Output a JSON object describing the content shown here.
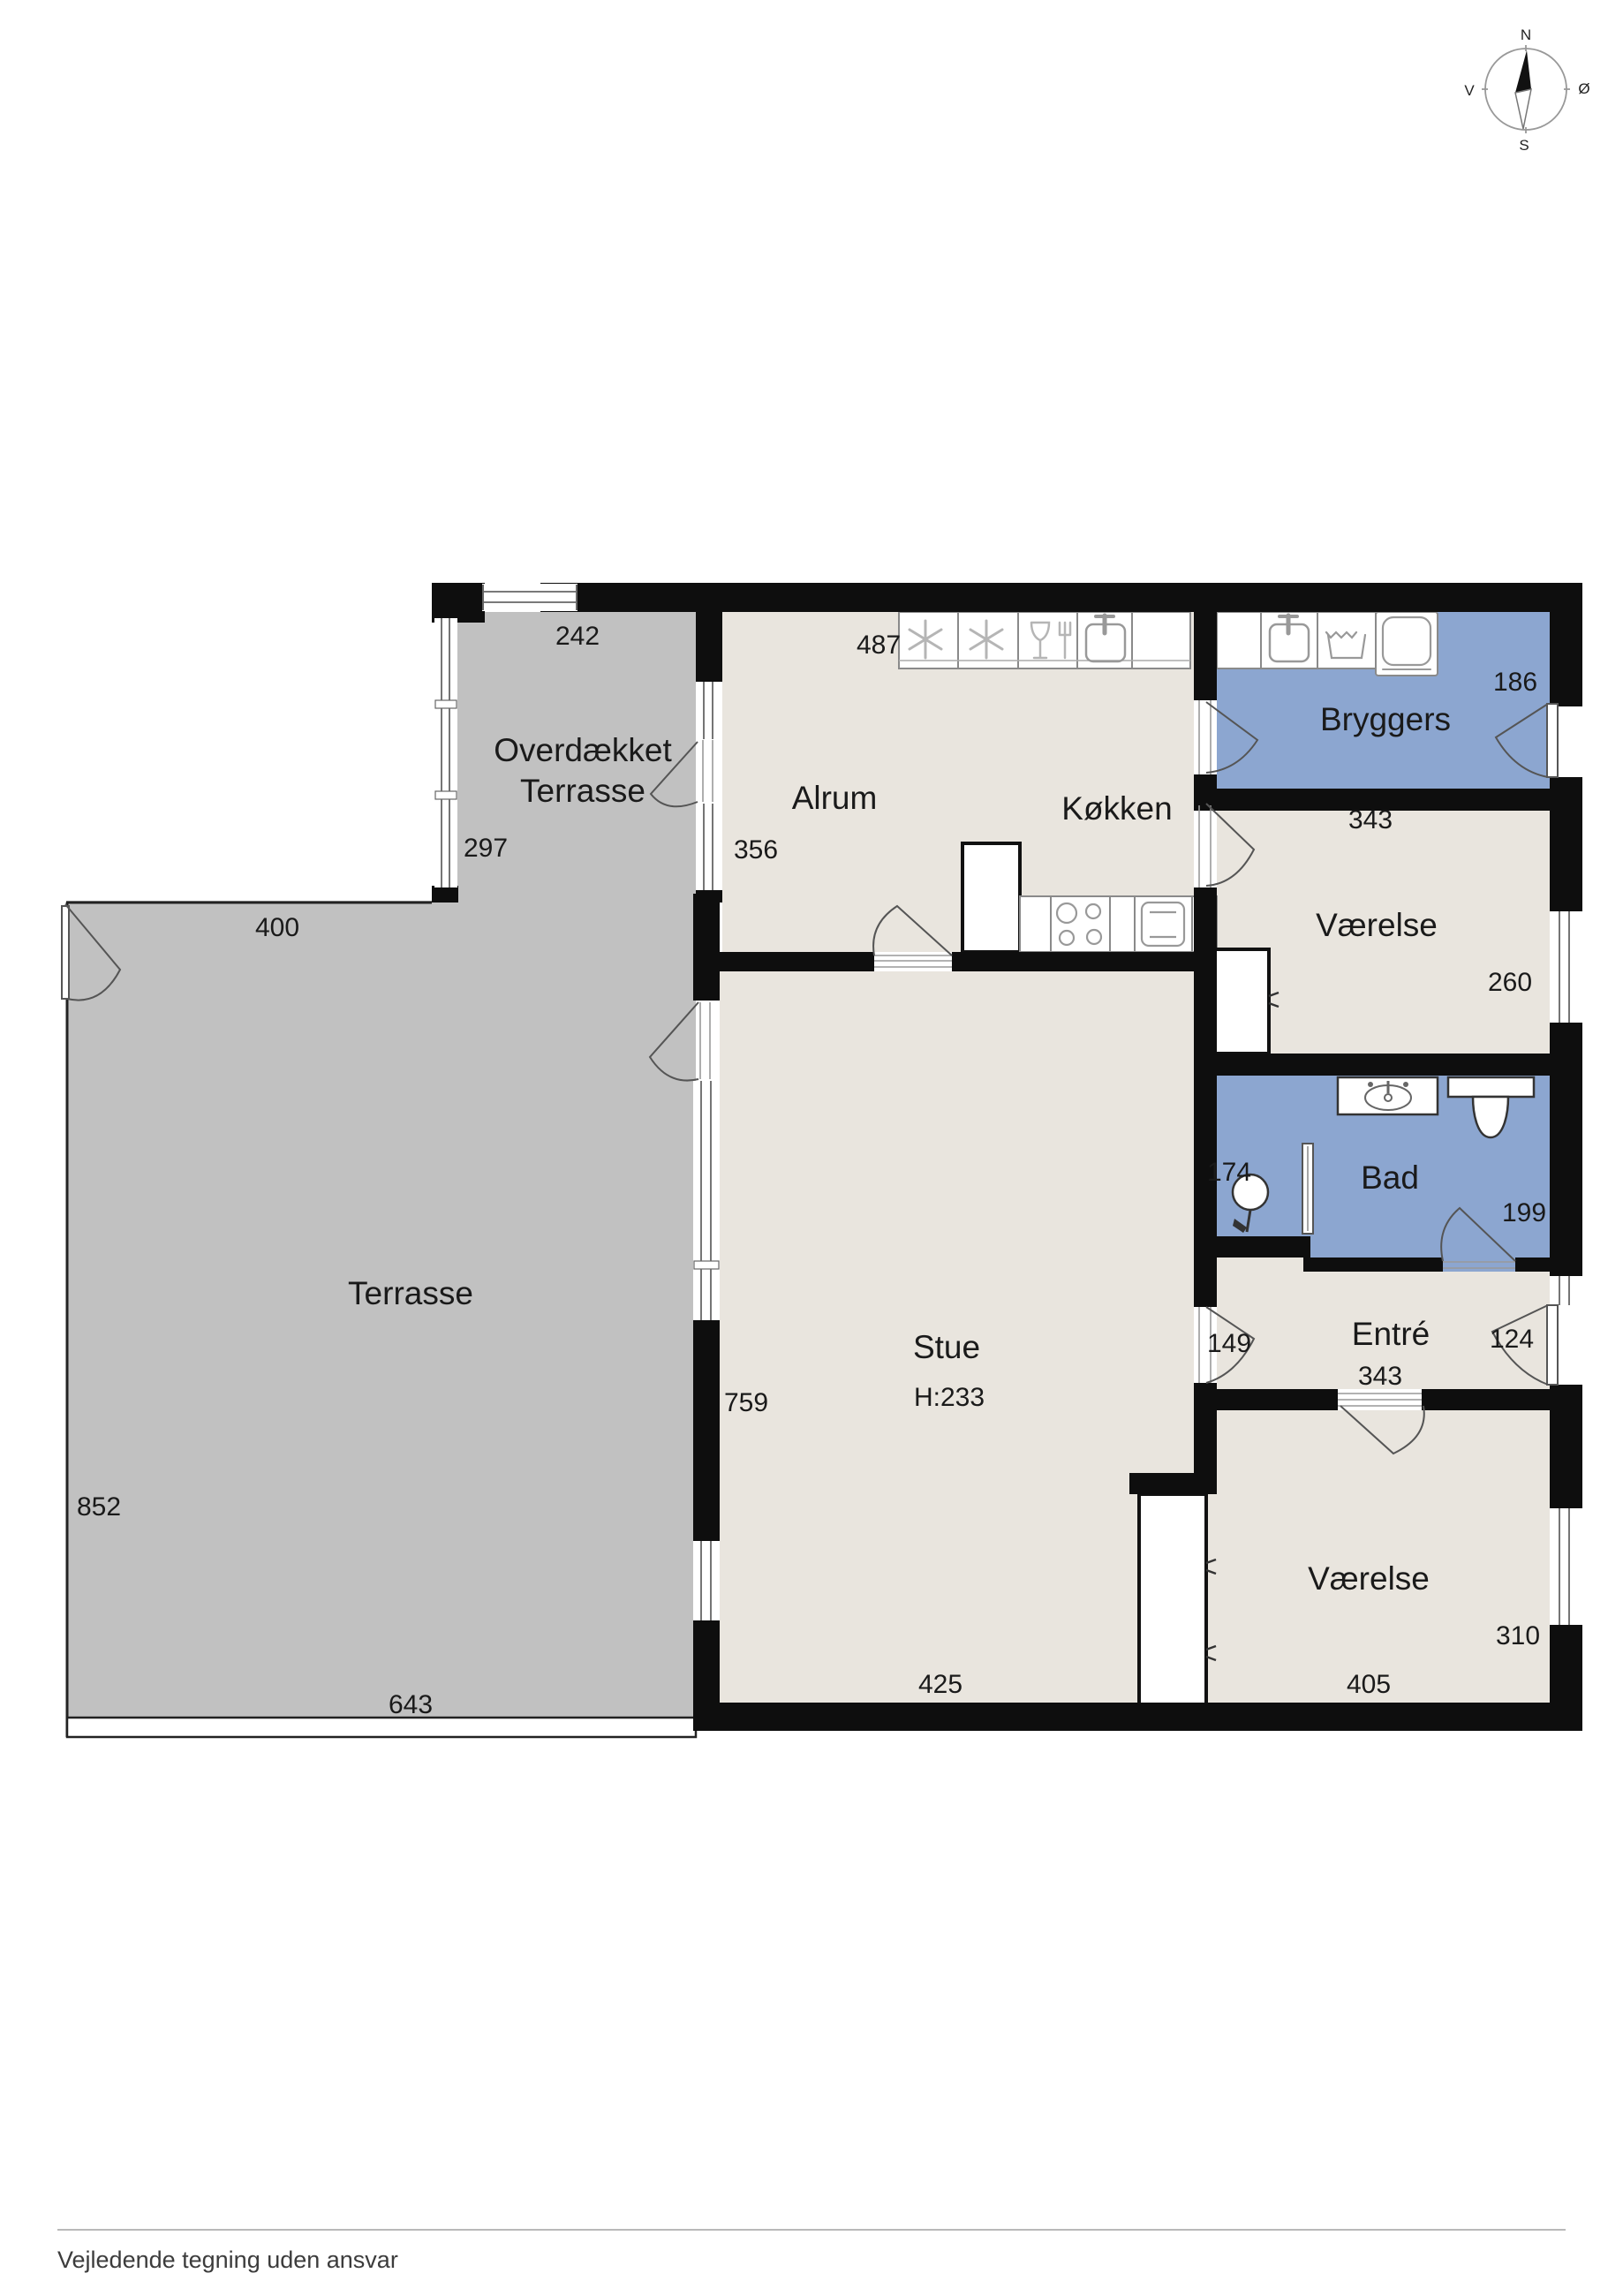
{
  "colors": {
    "terrace": "#c1c1c1",
    "floor": "#e9e5de",
    "wet": "#8ca6d0",
    "wall": "#0e0e0e",
    "white": "#ffffff"
  },
  "compass": {
    "north": "N",
    "south": "S",
    "west": "V",
    "east": "Ø"
  },
  "rooms": {
    "covered_terrace": {
      "label_line1": "Overdækket",
      "label_line2": "Terrasse",
      "dim_top": "242",
      "dim_left": "297"
    },
    "terrace": {
      "label": "Terrasse",
      "dim_top": "400",
      "dim_left": "852",
      "dim_bottom": "643"
    },
    "alrum": {
      "label": "Alrum",
      "dim_top": "487",
      "dim_left": "356"
    },
    "kitchen": {
      "label": "Køkken"
    },
    "bryggers": {
      "label": "Bryggers",
      "dim_right": "186",
      "dim_bottom": "343"
    },
    "bedroom_ne": {
      "label": "Værelse",
      "dim_top": "343",
      "dim_right": "260"
    },
    "bath": {
      "label": "Bad",
      "dim_left": "174",
      "dim_right": "199"
    },
    "entry": {
      "label": "Entré",
      "dim_door_left": "149",
      "dim_door_right": "124",
      "dim_bottom": "343"
    },
    "living": {
      "label": "Stue",
      "ceiling_height": "H:233",
      "dim_left": "759",
      "dim_bottom": "425"
    },
    "bedroom_se": {
      "label": "Værelse",
      "dim_bottom": "405",
      "dim_right": "310"
    }
  },
  "footer": {
    "disclaimer": "Vejledende tegning uden ansvar"
  }
}
